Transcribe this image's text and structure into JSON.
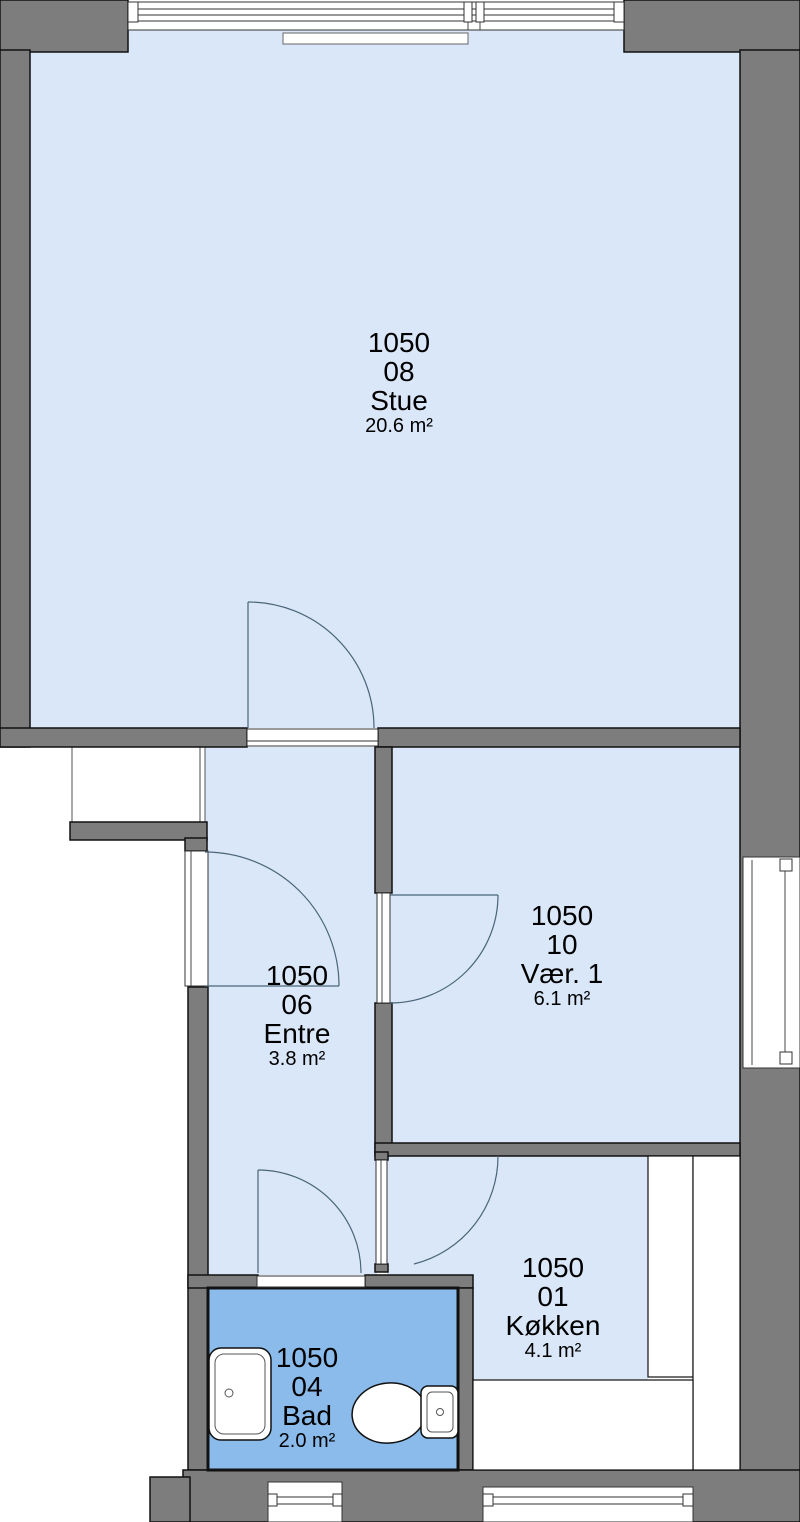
{
  "plan": {
    "rooms": [
      {
        "unit": "1050",
        "number": "08",
        "name": "Stue",
        "area": "20.6 m²"
      },
      {
        "unit": "1050",
        "number": "10",
        "name": "Vær. 1",
        "area": "6.1 m²"
      },
      {
        "unit": "1050",
        "number": "06",
        "name": "Entre",
        "area": "3.8 m²"
      },
      {
        "unit": "1050",
        "number": "01",
        "name": "Køkken",
        "area": "4.1 m²"
      },
      {
        "unit": "1050",
        "number": "04",
        "name": "Bad",
        "area": "2.0 m²"
      }
    ],
    "colors": {
      "wall": "#7d7d7d",
      "room_fill": "#d9e7f8",
      "bathroom_fill": "#8abbea",
      "outline": "#111111"
    }
  }
}
